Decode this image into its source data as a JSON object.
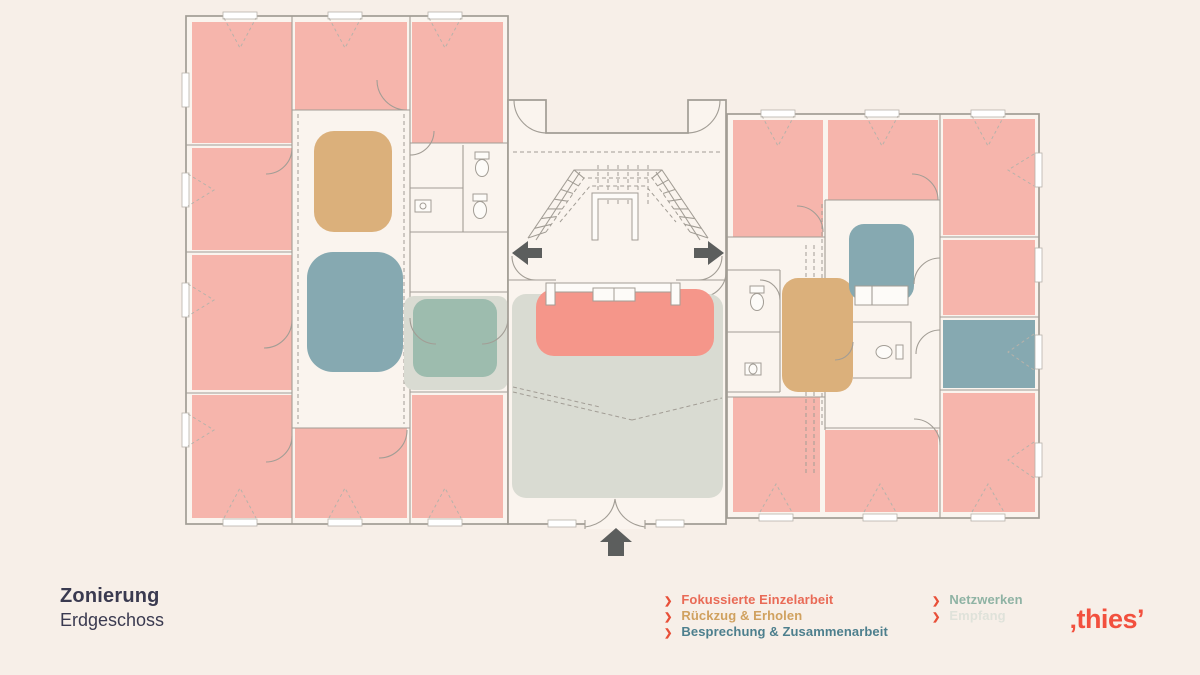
{
  "title": {
    "line1": "Zonierung",
    "line2": "Erdgeschoss"
  },
  "legend": {
    "bullet": "❯",
    "items_left": [
      {
        "label": "Fokussierte Einzelarbeit"
      },
      {
        "label": "Rückzug & Erholen"
      },
      {
        "label": "Besprechung & Zusammenarbeit"
      }
    ],
    "items_right": [
      {
        "label": "Netzwerken"
      },
      {
        "label": "Empfang"
      }
    ]
  },
  "logo": {
    "mark_left": "‚",
    "text": "thies",
    "mark_right": "’"
  },
  "colors": {
    "bg": "#f7efe8",
    "floor": "#faf4ee",
    "wall": "#a29d95",
    "pink": "#f6b5ac",
    "focus": "#f5968a",
    "retreat": "#dbb07b",
    "meeting": "#86a9b1",
    "network": "#9dbcae",
    "reception": "#d9dbd2",
    "arrow": "#5c5e5d",
    "title": "#3a3a50",
    "bullet": "#e84f38",
    "legend_focus": "#e96a56",
    "legend_retreat": "#d0a15f",
    "legend_meeting": "#4d7f8d",
    "legend_network": "#8fb3a4",
    "legend_reception": "#dfe2da",
    "logo": "#f2503e"
  }
}
